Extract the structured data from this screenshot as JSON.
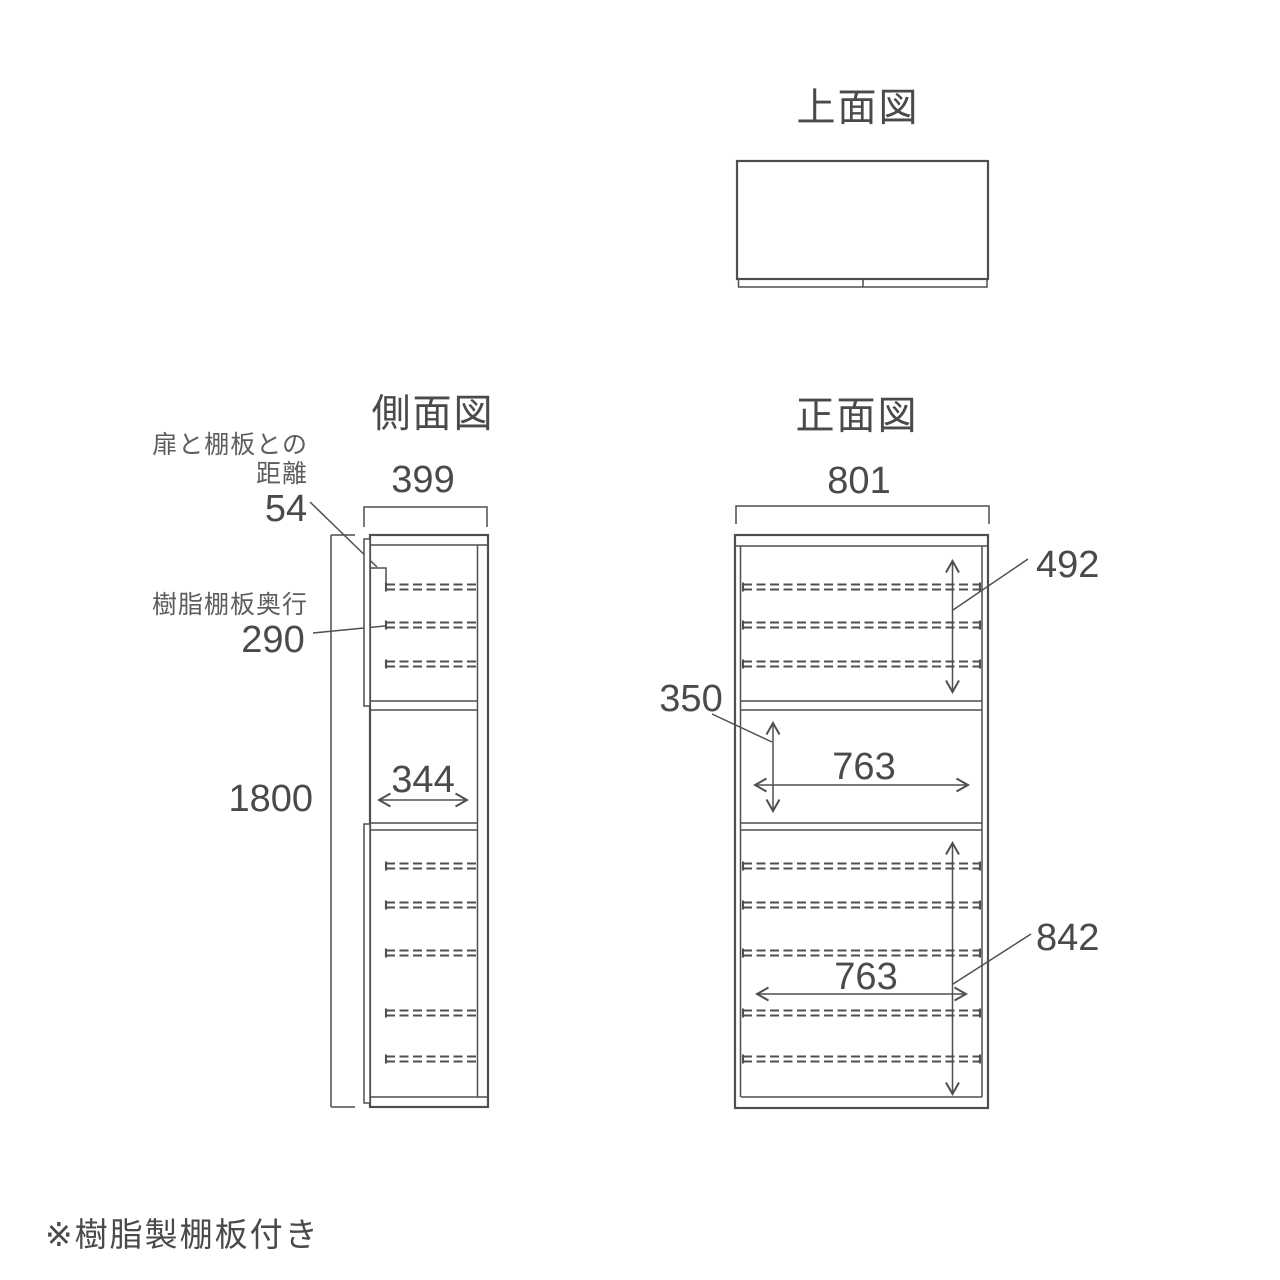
{
  "note": "※樹脂製棚板付き",
  "top_view": {
    "title": "上面図"
  },
  "side_view": {
    "title": "側面図",
    "dims": {
      "width": "399",
      "height": "1800",
      "open_depth": "344"
    },
    "annotations": {
      "door_gap_label_line1": "扉と棚板との",
      "door_gap_label_line2": "距離",
      "door_gap_value": "54",
      "shelf_depth_label": "樹脂棚板奥行",
      "shelf_depth_value": "290"
    }
  },
  "front_view": {
    "title": "正面図",
    "dims": {
      "width": "801",
      "top_section_height": "492",
      "middle_section_height": "350",
      "middle_inner_width": "763",
      "bottom_section_height": "842",
      "bottom_inner_width": "763"
    }
  },
  "colors": {
    "line": "#4f4f4f",
    "text": "#4a4a4a",
    "background": "#ffffff"
  }
}
